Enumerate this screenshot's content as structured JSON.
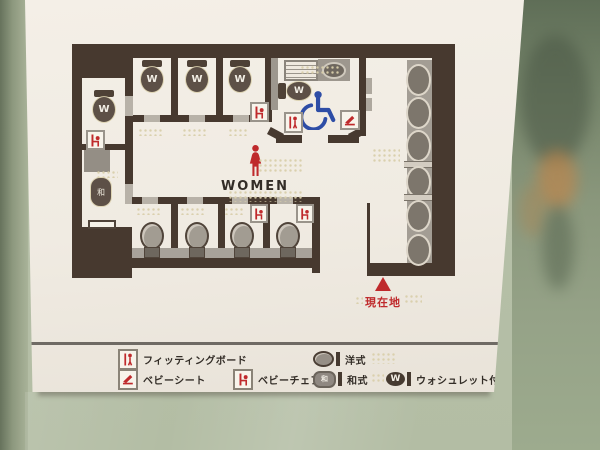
{
  "map": {
    "room_label": "WOMEN",
    "current_location": "現在地",
    "washlet_mark": "W",
    "japanese_mark": "和"
  },
  "legend": {
    "items": [
      {
        "name": "fitting-board",
        "label": "フィッティングボード"
      },
      {
        "name": "baby-sheet",
        "label": "ベビーシート"
      },
      {
        "name": "baby-chair",
        "label": "ベビーチェア"
      },
      {
        "name": "western-style",
        "label": "洋式"
      },
      {
        "name": "japanese-style",
        "label": "和式"
      },
      {
        "name": "washlet",
        "label": "ウォシュレット付"
      }
    ],
    "washlet_letter": "W",
    "japanese_letter": "和"
  },
  "colors": {
    "wall_brown": "#47392f",
    "floor_cream": "#f0ebe2",
    "fixture_gray": "#958f86",
    "accent_red": "#bf2a2c",
    "wheelchair_blue": "#2e4da6",
    "glass_green": "#8d9c82",
    "braille_dot": "#d9cfab"
  }
}
